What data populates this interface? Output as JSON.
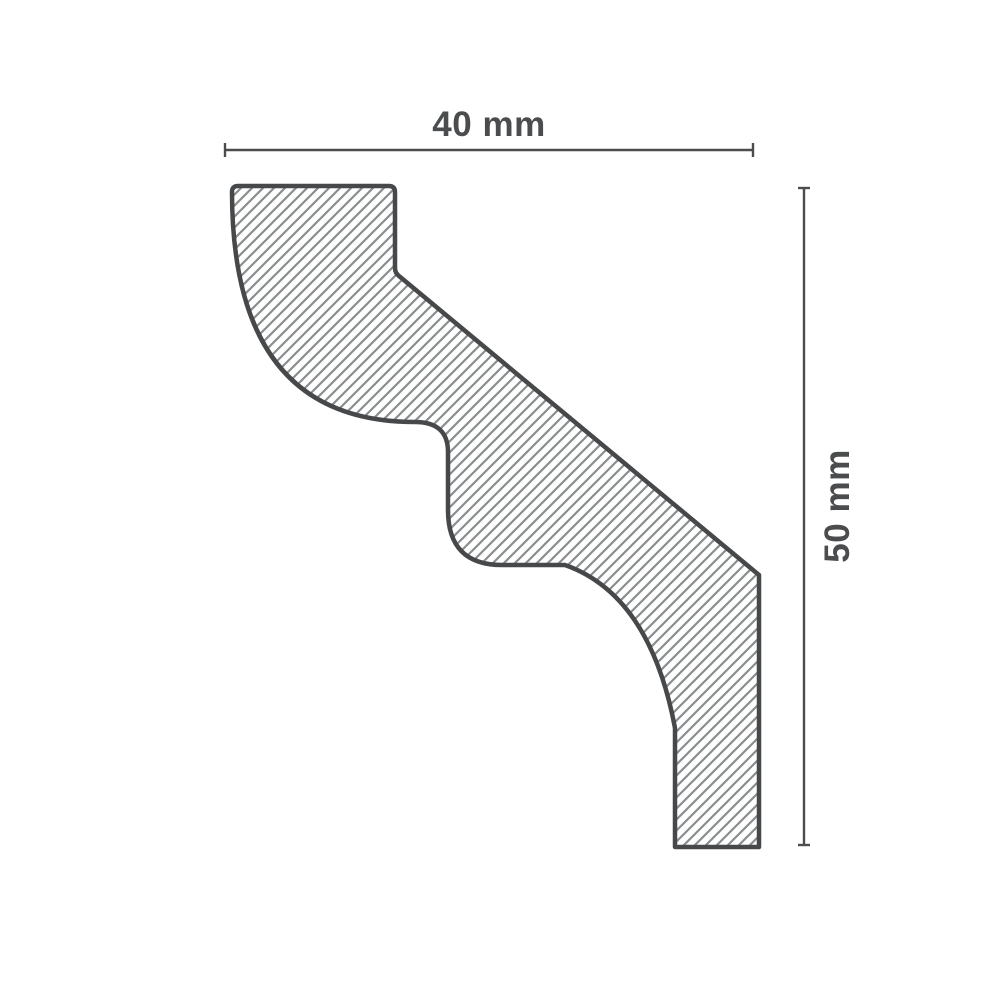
{
  "diagram": {
    "type": "technical-profile-cross-section",
    "subject": "crown molding profile",
    "dimensions": {
      "width": {
        "label": "40 mm",
        "value": 40,
        "unit": "mm"
      },
      "height": {
        "label": "50 mm",
        "value": 50,
        "unit": "mm"
      }
    },
    "colors": {
      "background": "#ffffff",
      "outline": "#46484a",
      "hatch": "#8a8d8f",
      "dimension": "#4a4c4e"
    }
  }
}
